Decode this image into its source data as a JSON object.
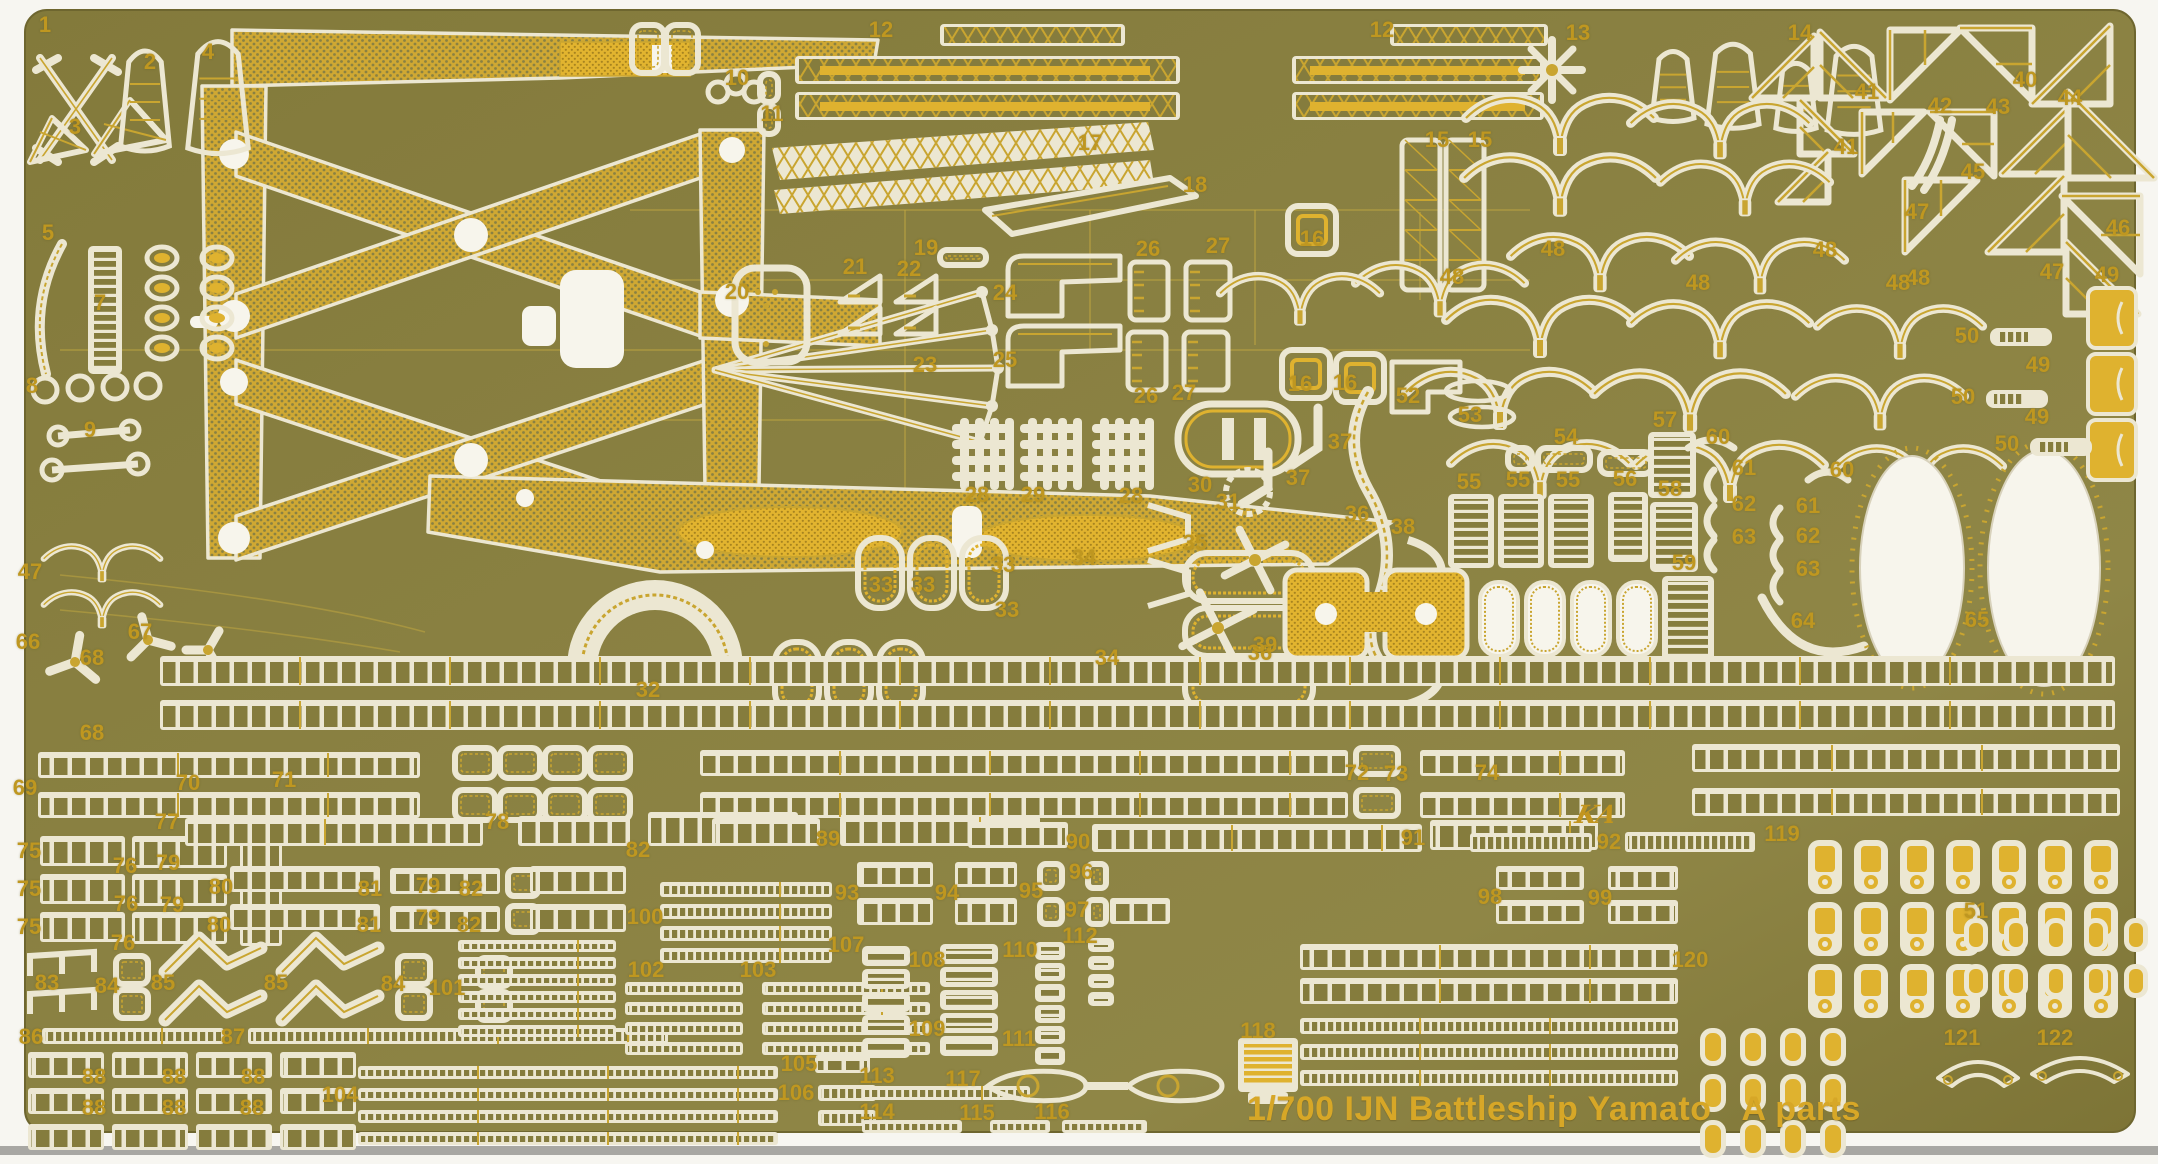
{
  "sheet": {
    "title": "1/700 IJN Battleship Yamato",
    "parts_set": "A parts",
    "brand_logo": "KA"
  },
  "colors": {
    "page_white": "#f7f6f1",
    "scan_bar_gray": "#a8a7a3",
    "fret_olive": "#857c3d",
    "fret_olive_dark": "#6e662f",
    "fret_olive_light": "#8f8746",
    "etched_cream": "#ece7d2",
    "white_cutout": "#f7f5ec",
    "gold_detail": "#c9a530",
    "bright_gold": "#dfb22f",
    "label_gold": "#bf9720",
    "title_gold": "#d7a727"
  },
  "part_labels": [
    {
      "n": "1",
      "x": 45,
      "y": 25
    },
    {
      "n": "2",
      "x": 150,
      "y": 62
    },
    {
      "n": "3",
      "x": 75,
      "y": 127
    },
    {
      "n": "4",
      "x": 208,
      "y": 52
    },
    {
      "n": "5",
      "x": 48,
      "y": 233
    },
    {
      "n": "7",
      "x": 100,
      "y": 303
    },
    {
      "n": "8",
      "x": 32,
      "y": 386
    },
    {
      "n": "9",
      "x": 90,
      "y": 430
    },
    {
      "n": "10",
      "x": 737,
      "y": 78
    },
    {
      "n": "11",
      "x": 772,
      "y": 114
    },
    {
      "n": "12",
      "x": 881,
      "y": 30
    },
    {
      "n": "12",
      "x": 1382,
      "y": 30
    },
    {
      "n": "13",
      "x": 1578,
      "y": 33
    },
    {
      "n": "14",
      "x": 1800,
      "y": 33
    },
    {
      "n": "15",
      "x": 1437,
      "y": 140
    },
    {
      "n": "15",
      "x": 1480,
      "y": 140
    },
    {
      "n": "16",
      "x": 1312,
      "y": 239
    },
    {
      "n": "16",
      "x": 1300,
      "y": 384
    },
    {
      "n": "16",
      "x": 1345,
      "y": 383
    },
    {
      "n": "17",
      "x": 1090,
      "y": 143
    },
    {
      "n": "18",
      "x": 1195,
      "y": 185
    },
    {
      "n": "19",
      "x": 926,
      "y": 248
    },
    {
      "n": "20",
      "x": 737,
      "y": 292
    },
    {
      "n": "21",
      "x": 855,
      "y": 267
    },
    {
      "n": "22",
      "x": 909,
      "y": 269
    },
    {
      "n": "23",
      "x": 925,
      "y": 365
    },
    {
      "n": "24",
      "x": 1005,
      "y": 293
    },
    {
      "n": "25",
      "x": 1005,
      "y": 360
    },
    {
      "n": "26",
      "x": 1148,
      "y": 249
    },
    {
      "n": "27",
      "x": 1218,
      "y": 246
    },
    {
      "n": "26",
      "x": 1146,
      "y": 396
    },
    {
      "n": "27",
      "x": 1184,
      "y": 393
    },
    {
      "n": "28",
      "x": 977,
      "y": 495
    },
    {
      "n": "29",
      "x": 1033,
      "y": 495
    },
    {
      "n": "28",
      "x": 1131,
      "y": 496
    },
    {
      "n": "30",
      "x": 1200,
      "y": 485
    },
    {
      "n": "31",
      "x": 1228,
      "y": 502
    },
    {
      "n": "32",
      "x": 648,
      "y": 690
    },
    {
      "n": "33",
      "x": 881,
      "y": 585
    },
    {
      "n": "33",
      "x": 923,
      "y": 585
    },
    {
      "n": "33",
      "x": 1003,
      "y": 565
    },
    {
      "n": "33",
      "x": 1007,
      "y": 610
    },
    {
      "n": "34",
      "x": 1084,
      "y": 558
    },
    {
      "n": "34",
      "x": 1107,
      "y": 658
    },
    {
      "n": "35",
      "x": 1195,
      "y": 543
    },
    {
      "n": "36",
      "x": 1357,
      "y": 514
    },
    {
      "n": "36",
      "x": 1260,
      "y": 653
    },
    {
      "n": "37",
      "x": 1340,
      "y": 442
    },
    {
      "n": "37",
      "x": 1298,
      "y": 478
    },
    {
      "n": "38",
      "x": 1403,
      "y": 527
    },
    {
      "n": "39",
      "x": 1265,
      "y": 645
    },
    {
      "n": "40",
      "x": 2025,
      "y": 80
    },
    {
      "n": "41",
      "x": 1867,
      "y": 92
    },
    {
      "n": "41",
      "x": 1846,
      "y": 147
    },
    {
      "n": "42",
      "x": 1940,
      "y": 106
    },
    {
      "n": "43",
      "x": 1998,
      "y": 107
    },
    {
      "n": "44",
      "x": 2070,
      "y": 98
    },
    {
      "n": "45",
      "x": 1973,
      "y": 172
    },
    {
      "n": "46",
      "x": 2118,
      "y": 228
    },
    {
      "n": "47",
      "x": 1917,
      "y": 212
    },
    {
      "n": "47",
      "x": 2052,
      "y": 272
    },
    {
      "n": "47",
      "x": 30,
      "y": 572
    },
    {
      "n": "48",
      "x": 1825,
      "y": 250
    },
    {
      "n": "48",
      "x": 1918,
      "y": 278
    },
    {
      "n": "48",
      "x": 1698,
      "y": 283
    },
    {
      "n": "48",
      "x": 1898,
      "y": 283
    },
    {
      "n": "48",
      "x": 1452,
      "y": 277
    },
    {
      "n": "48",
      "x": 1553,
      "y": 249
    },
    {
      "n": "49",
      "x": 2107,
      "y": 275
    },
    {
      "n": "49",
      "x": 2038,
      "y": 365
    },
    {
      "n": "49",
      "x": 2037,
      "y": 417
    },
    {
      "n": "50",
      "x": 1967,
      "y": 336
    },
    {
      "n": "50",
      "x": 1963,
      "y": 397
    },
    {
      "n": "50",
      "x": 2007,
      "y": 444
    },
    {
      "n": "51",
      "x": 1976,
      "y": 911
    },
    {
      "n": "52",
      "x": 1408,
      "y": 396
    },
    {
      "n": "53",
      "x": 1470,
      "y": 415
    },
    {
      "n": "54",
      "x": 1566,
      "y": 437
    },
    {
      "n": "55",
      "x": 1469,
      "y": 482
    },
    {
      "n": "55",
      "x": 1518,
      "y": 480
    },
    {
      "n": "55",
      "x": 1568,
      "y": 480
    },
    {
      "n": "56",
      "x": 1625,
      "y": 479
    },
    {
      "n": "57",
      "x": 1665,
      "y": 420
    },
    {
      "n": "58",
      "x": 1670,
      "y": 489
    },
    {
      "n": "59",
      "x": 1684,
      "y": 563
    },
    {
      "n": "60",
      "x": 1718,
      "y": 437
    },
    {
      "n": "60",
      "x": 1842,
      "y": 470
    },
    {
      "n": "61",
      "x": 1744,
      "y": 468
    },
    {
      "n": "61",
      "x": 1808,
      "y": 506
    },
    {
      "n": "62",
      "x": 1744,
      "y": 504
    },
    {
      "n": "62",
      "x": 1808,
      "y": 536
    },
    {
      "n": "63",
      "x": 1744,
      "y": 537
    },
    {
      "n": "63",
      "x": 1808,
      "y": 569
    },
    {
      "n": "64",
      "x": 1803,
      "y": 621
    },
    {
      "n": "65",
      "x": 1977,
      "y": 620
    },
    {
      "n": "66",
      "x": 28,
      "y": 642
    },
    {
      "n": "67",
      "x": 140,
      "y": 632
    },
    {
      "n": "68",
      "x": 92,
      "y": 658
    },
    {
      "n": "68",
      "x": 92,
      "y": 733
    },
    {
      "n": "69",
      "x": 25,
      "y": 788
    },
    {
      "n": "70",
      "x": 188,
      "y": 783
    },
    {
      "n": "71",
      "x": 284,
      "y": 780
    },
    {
      "n": "72",
      "x": 1357,
      "y": 773
    },
    {
      "n": "73",
      "x": 1396,
      "y": 774
    },
    {
      "n": "74",
      "x": 1487,
      "y": 773
    },
    {
      "n": "75",
      "x": 29,
      "y": 851
    },
    {
      "n": "75",
      "x": 29,
      "y": 889
    },
    {
      "n": "75",
      "x": 29,
      "y": 927
    },
    {
      "n": "76",
      "x": 125,
      "y": 866
    },
    {
      "n": "76",
      "x": 126,
      "y": 904
    },
    {
      "n": "76",
      "x": 123,
      "y": 943
    },
    {
      "n": "77",
      "x": 167,
      "y": 822
    },
    {
      "n": "78",
      "x": 497,
      "y": 822
    },
    {
      "n": "79",
      "x": 168,
      "y": 863
    },
    {
      "n": "79",
      "x": 172,
      "y": 905
    },
    {
      "n": "79",
      "x": 428,
      "y": 886
    },
    {
      "n": "79",
      "x": 428,
      "y": 918
    },
    {
      "n": "80",
      "x": 221,
      "y": 887
    },
    {
      "n": "80",
      "x": 219,
      "y": 925
    },
    {
      "n": "81",
      "x": 370,
      "y": 889
    },
    {
      "n": "81",
      "x": 369,
      "y": 925
    },
    {
      "n": "82",
      "x": 471,
      "y": 889
    },
    {
      "n": "82",
      "x": 469,
      "y": 925
    },
    {
      "n": "82",
      "x": 638,
      "y": 850
    },
    {
      "n": "83",
      "x": 47,
      "y": 983
    },
    {
      "n": "84",
      "x": 107,
      "y": 986
    },
    {
      "n": "84",
      "x": 393,
      "y": 984
    },
    {
      "n": "85",
      "x": 163,
      "y": 983
    },
    {
      "n": "85",
      "x": 276,
      "y": 983
    },
    {
      "n": "86",
      "x": 31,
      "y": 1037
    },
    {
      "n": "87",
      "x": 233,
      "y": 1037
    },
    {
      "n": "88",
      "x": 94,
      "y": 1077
    },
    {
      "n": "88",
      "x": 174,
      "y": 1077
    },
    {
      "n": "88",
      "x": 253,
      "y": 1077
    },
    {
      "n": "88",
      "x": 94,
      "y": 1108
    },
    {
      "n": "88",
      "x": 174,
      "y": 1108
    },
    {
      "n": "88",
      "x": 252,
      "y": 1108
    },
    {
      "n": "89",
      "x": 828,
      "y": 839
    },
    {
      "n": "90",
      "x": 1078,
      "y": 842
    },
    {
      "n": "91",
      "x": 1413,
      "y": 838
    },
    {
      "n": "92",
      "x": 1609,
      "y": 842
    },
    {
      "n": "93",
      "x": 847,
      "y": 893
    },
    {
      "n": "94",
      "x": 947,
      "y": 893
    },
    {
      "n": "95",
      "x": 1031,
      "y": 891
    },
    {
      "n": "96",
      "x": 1081,
      "y": 872
    },
    {
      "n": "97",
      "x": 1077,
      "y": 910
    },
    {
      "n": "98",
      "x": 1490,
      "y": 897
    },
    {
      "n": "99",
      "x": 1600,
      "y": 898
    },
    {
      "n": "100",
      "x": 645,
      "y": 917
    },
    {
      "n": "101",
      "x": 447,
      "y": 988
    },
    {
      "n": "102",
      "x": 646,
      "y": 970
    },
    {
      "n": "103",
      "x": 758,
      "y": 970
    },
    {
      "n": "104",
      "x": 340,
      "y": 1095
    },
    {
      "n": "105",
      "x": 799,
      "y": 1064
    },
    {
      "n": "106",
      "x": 796,
      "y": 1093
    },
    {
      "n": "107",
      "x": 846,
      "y": 945
    },
    {
      "n": "108",
      "x": 927,
      "y": 960
    },
    {
      "n": "109",
      "x": 927,
      "y": 1029
    },
    {
      "n": "110",
      "x": 1020,
      "y": 950
    },
    {
      "n": "111",
      "x": 1019,
      "y": 1039
    },
    {
      "n": "112",
      "x": 1080,
      "y": 936
    },
    {
      "n": "113",
      "x": 877,
      "y": 1076
    },
    {
      "n": "114",
      "x": 877,
      "y": 1112
    },
    {
      "n": "115",
      "x": 977,
      "y": 1113
    },
    {
      "n": "116",
      "x": 1052,
      "y": 1112
    },
    {
      "n": "117",
      "x": 963,
      "y": 1079
    },
    {
      "n": "118",
      "x": 1258,
      "y": 1031
    },
    {
      "n": "119",
      "x": 1782,
      "y": 834
    },
    {
      "n": "120",
      "x": 1690,
      "y": 960
    },
    {
      "n": "121",
      "x": 1962,
      "y": 1038
    },
    {
      "n": "122",
      "x": 2055,
      "y": 1038
    }
  ]
}
